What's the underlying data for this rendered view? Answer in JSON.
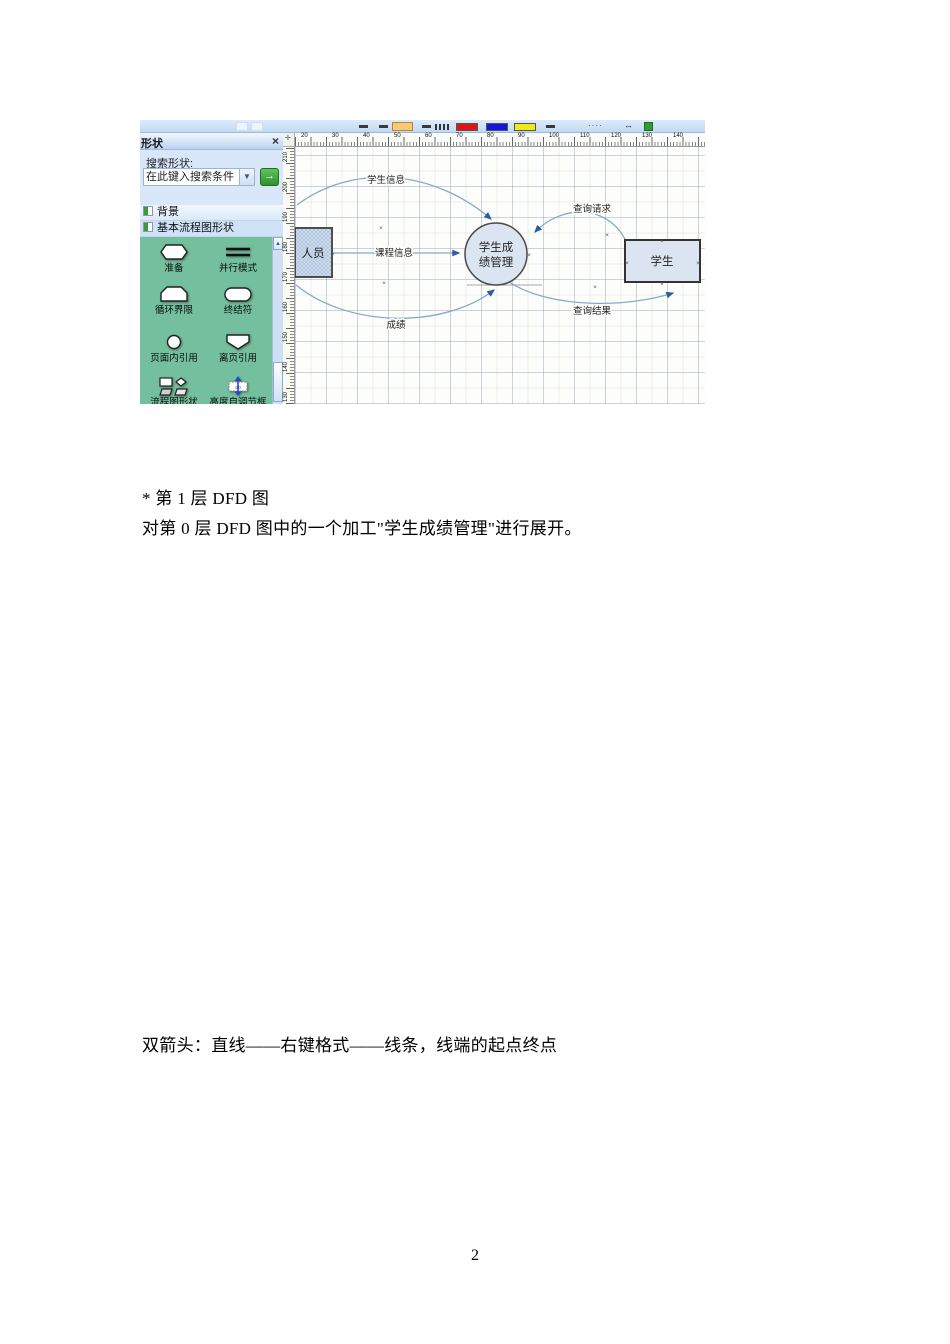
{
  "page": {
    "number": "2"
  },
  "document": {
    "para1_line1": "* 第 1 层 DFD 图",
    "para1_line2": "对第 0 层 DFD 图中的一个加工\"学生成绩管理\"进行展开。",
    "para2": "双箭头：直线——右键格式——线条，线端的起点终点"
  },
  "visio": {
    "toolbar": {
      "swatch_red": "#e01414",
      "swatch_blue": "#1616d6",
      "swatch_yellow": "#f2ea16"
    },
    "shapes_panel": {
      "title": "形状",
      "close_glyph": "×",
      "search_label": "搜索形状:",
      "search_value": "在此键入搜索条件",
      "dropdown_glyph": "▼",
      "go_glyph": "→",
      "sections": [
        {
          "label": "背景"
        },
        {
          "label": "基本流程图形状"
        }
      ],
      "stencil": {
        "bg_color": "#74bf9e",
        "scroll_up_glyph": "▲",
        "items": [
          {
            "label": "准备",
            "icon": "hexagon"
          },
          {
            "label": "并行模式",
            "icon": "parallel-lines"
          },
          {
            "label": "循环界限",
            "icon": "loop-limit"
          },
          {
            "label": "终结符",
            "icon": "terminator"
          },
          {
            "label": "页面内引用",
            "icon": "small-circle"
          },
          {
            "label": "离页引用",
            "icon": "off-page-pentagon"
          },
          {
            "label": "流程图形状",
            "icon": "shape-group"
          },
          {
            "label": "高度自调节框",
            "icon": "auto-height-box"
          }
        ]
      }
    },
    "canvas": {
      "h_ruler_labels": [
        "20",
        "30",
        "40",
        "50",
        "60",
        "70",
        "80",
        "90",
        "100",
        "110",
        "120",
        "130",
        "140"
      ],
      "v_ruler_labels": [
        "210",
        "200",
        "190",
        "180",
        "170",
        "160",
        "150",
        "140",
        "130"
      ],
      "diagram": {
        "entity_left": "人员",
        "process_line1": "学生成",
        "process_line2": "绩管理",
        "entity_right": "学生",
        "flows": {
          "top": "学生信息",
          "mid": "课程信息",
          "bottom_left": "成绩",
          "request": "查询请求",
          "result": "查询结果"
        },
        "colors": {
          "shape_fill": "#dbe5f1",
          "arrow_line": "#88a9c9",
          "arrowhead": "#2e5d9e"
        }
      }
    }
  }
}
